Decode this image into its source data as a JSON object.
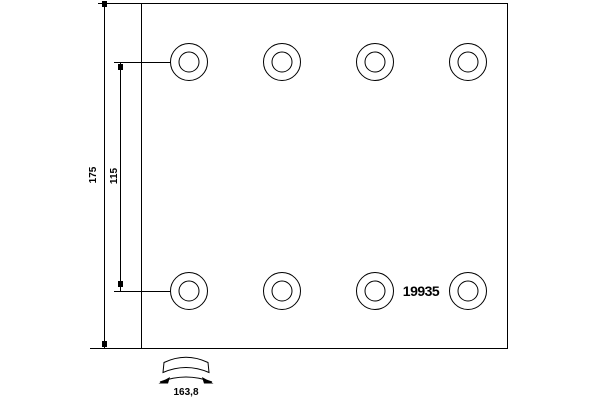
{
  "diagram": {
    "part_number": "19935",
    "dimensions": {
      "overall_height": "175",
      "hole_spacing": "115",
      "arc_width": "163,8"
    },
    "holes": {
      "rows": 2,
      "columns": 4,
      "total": 8
    },
    "colors": {
      "line": "#000000",
      "background": "#ffffff"
    }
  }
}
